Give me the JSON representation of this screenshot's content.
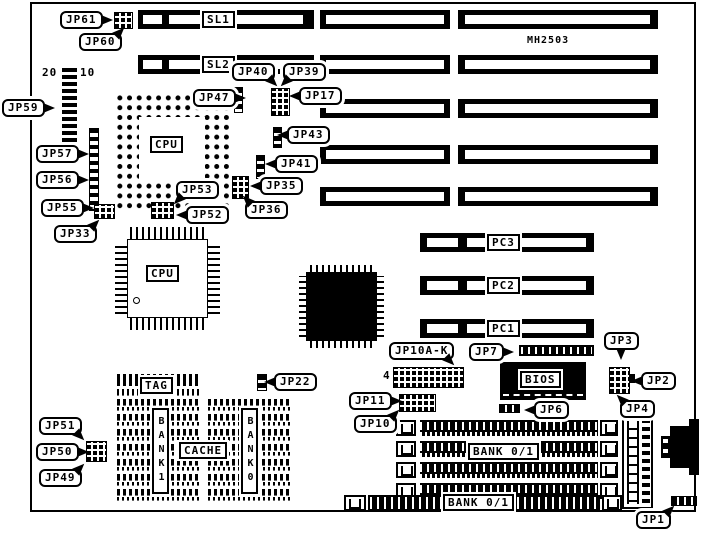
{
  "diagram": {
    "model": "MH2503",
    "slot_labels": {
      "sl1": "SL1",
      "sl2": "SL2",
      "pc1": "PC1",
      "pc2": "PC2",
      "pc3": "PC3"
    },
    "chip_labels": {
      "cpu": "CPU",
      "bios": "BIOS",
      "tag": "TAG",
      "cache": "CACHE",
      "bank1": "BANK1",
      "bank0": "BANK0",
      "bank01": "BANK 0/1"
    },
    "jumper_labels": {
      "jp1": "JP1",
      "jp2": "JP2",
      "jp3": "JP3",
      "jp4": "JP4",
      "jp6": "JP6",
      "jp7": "JP7",
      "jp10": "JP10",
      "jp10ak": "JP10A-K",
      "jp11": "JP11",
      "jp17": "JP17",
      "jp22": "JP22",
      "jp33": "JP33",
      "jp35": "JP35",
      "jp36": "JP36",
      "jp39": "JP39",
      "jp40": "JP40",
      "jp41": "JP41",
      "jp43": "JP43",
      "jp47": "JP47",
      "jp49": "JP49",
      "jp50": "JP50",
      "jp51": "JP51",
      "jp52": "JP52",
      "jp53": "JP53",
      "jp55": "JP55",
      "jp56": "JP56",
      "jp57": "JP57",
      "jp59": "JP59",
      "jp60": "JP60",
      "jp61": "JP61"
    },
    "pin_annotations": {
      "p20": "20",
      "p10": "10",
      "p4": "4"
    },
    "colors": {
      "ink": "#000000",
      "paper": "#ffffff"
    }
  }
}
